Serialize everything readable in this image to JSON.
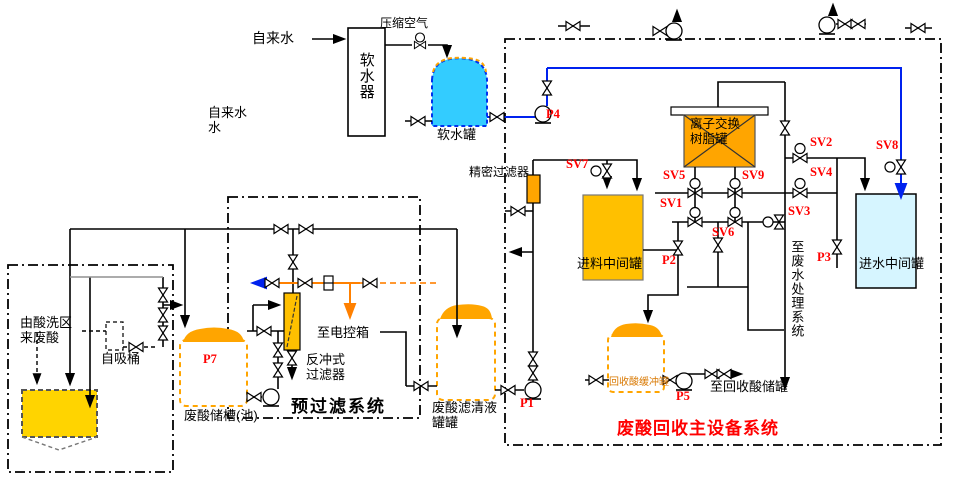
{
  "labels": {
    "tap_water": "自来水",
    "tap_water_left": "自来水\n水",
    "compressed_air": "压缩空气",
    "softener": "软水器",
    "soft_water_tank": "软水罐",
    "precision_filter": "精密过滤器",
    "ion_exchange_tank": "离子交换\n树脂罐",
    "feed_tank": "进料中间罐",
    "inlet_water_tank": "进水中间罐",
    "to_wastewater": "至废水处理系统",
    "buffer_tank": "回收酸缓冲罐",
    "to_recovered_acid_tank": "至回收酸储罐",
    "main_system_title": "废酸回收主设备系统",
    "prefilter_title": "预过滤系统",
    "backwash_filter": "反冲式\n过滤器",
    "to_control_box": "至电控箱",
    "filtrate_tank": "废酸滤清液\n罐罐",
    "waste_acid_pit": "废酸储槽(池)",
    "from_pickling": "由酸洗区\n来废酸",
    "self_priming_barrel": "自吸桶"
  },
  "valves": {
    "sv1": "SV1",
    "sv2": "SV2",
    "sv3": "SV3",
    "sv4": "SV4",
    "sv5": "SV5",
    "sv6": "SV6",
    "sv7": "SV7",
    "sv8": "SV8",
    "sv9": "SV9"
  },
  "pumps": {
    "p1": "P1",
    "p2": "P2",
    "p3": "P3",
    "p4": "P4",
    "p5": "P5",
    "p7": "P7"
  },
  "colors": {
    "pipe_blue": "#0022EE",
    "pipe_orange": "#FF8000",
    "tank_orange": "#FFA500",
    "tank_yellow_orange": "#FFC000",
    "pool_yellow": "#FFD400",
    "soft_tank_cyan": "#33CCFF",
    "inlet_tank_pale": "#D6F5FF",
    "label_red": "#FF0000"
  }
}
